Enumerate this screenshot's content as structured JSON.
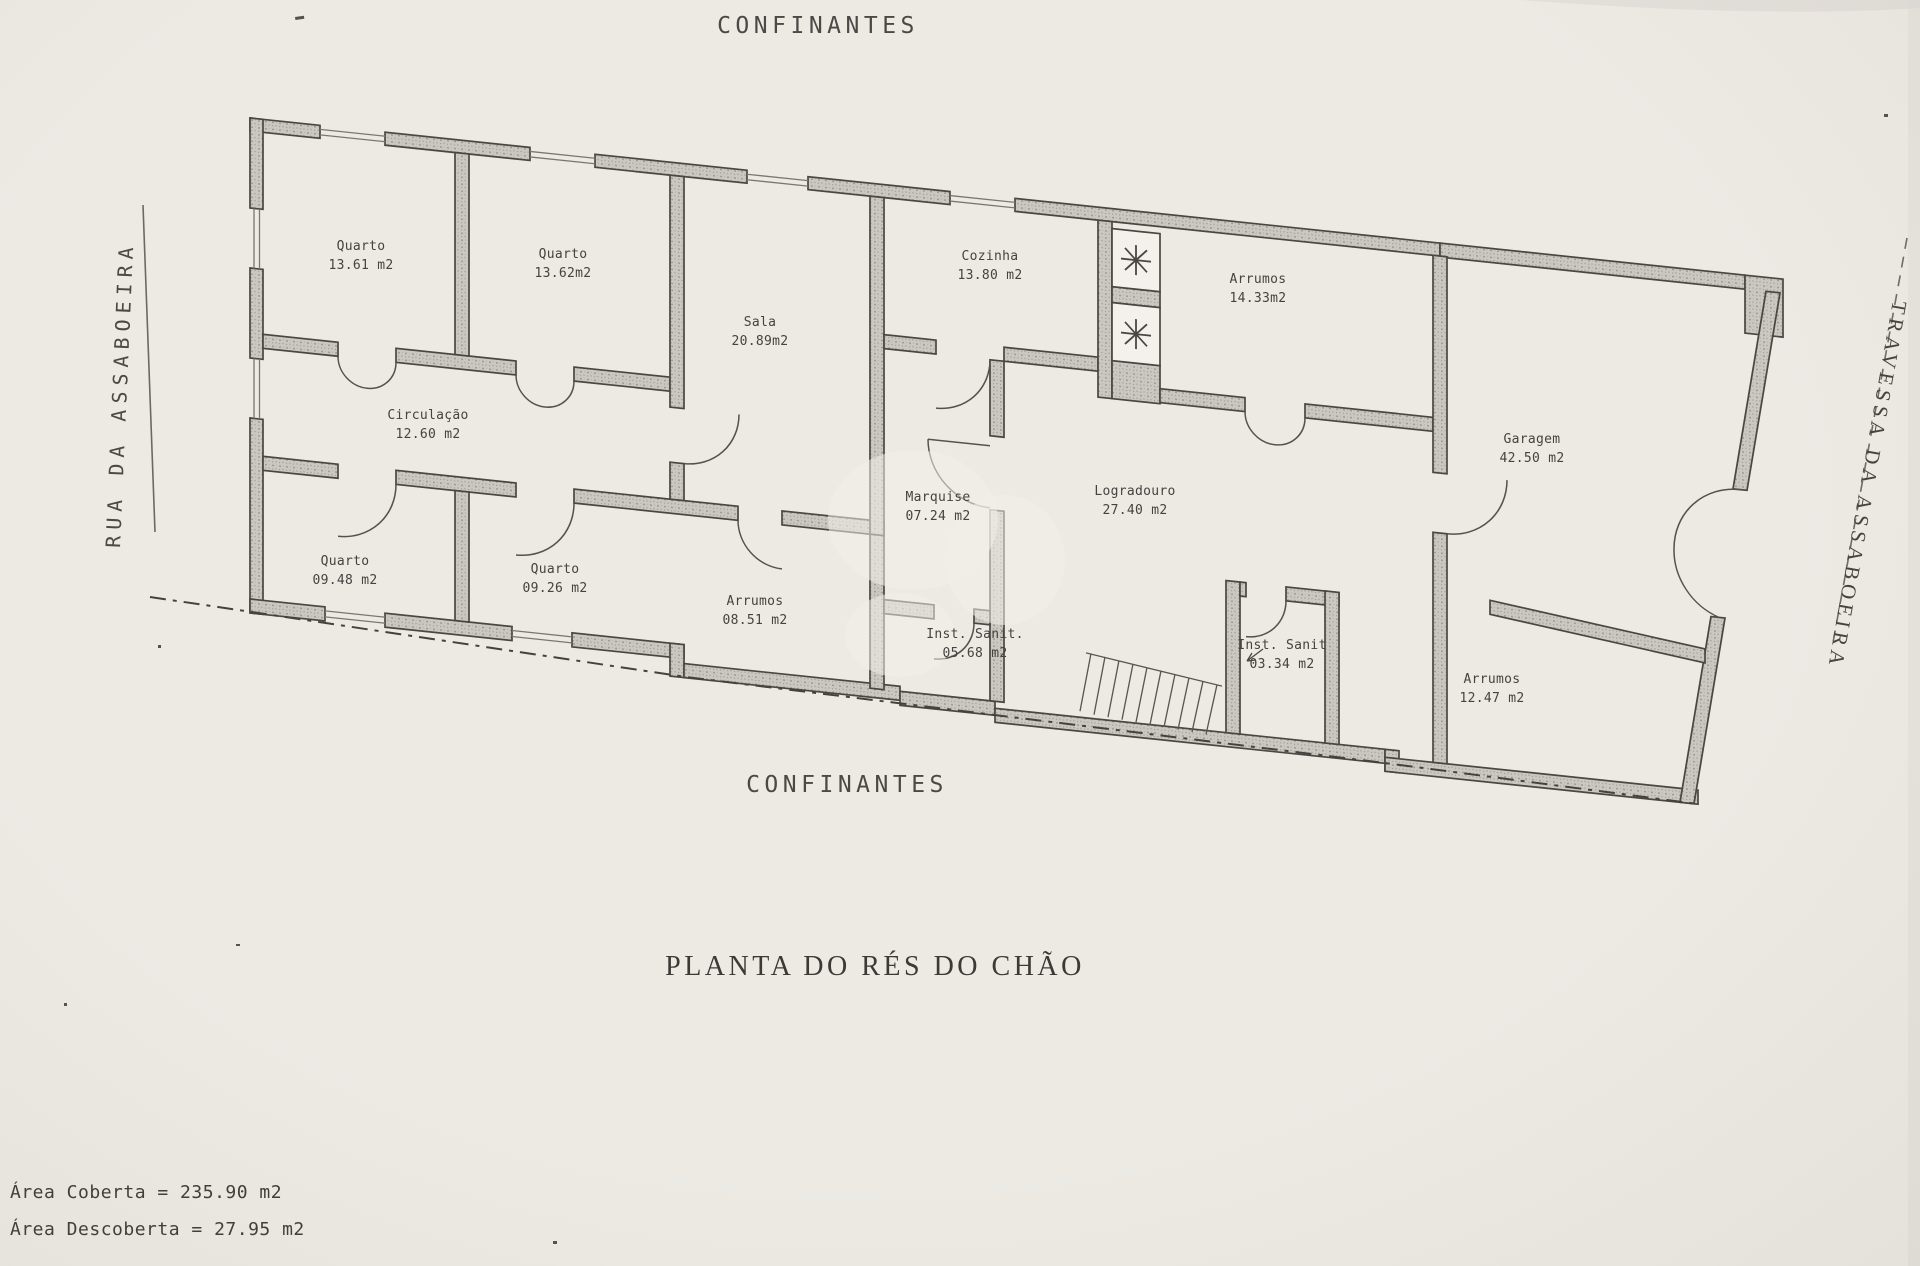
{
  "document": {
    "plan_title": "PLANTA DO RÉS DO CHÃO",
    "area_covered": "Área Coberta = 235.90 m2",
    "area_uncovered": "Área Descoberta = 27.95 m2"
  },
  "boundaries": {
    "top_label": "CONFINANTES",
    "bottom_label": "CONFINANTES",
    "left_street": "RUA DA ASSABOEIRA",
    "right_street": "TRAVESSA DA ASSABOEIRA"
  },
  "rooms": [
    {
      "name": "Quarto",
      "area": "13.61 m2"
    },
    {
      "name": "Quarto",
      "area": "13.62m2"
    },
    {
      "name": "Sala",
      "area": "20.89m2"
    },
    {
      "name": "Cozinha",
      "area": "13.80 m2"
    },
    {
      "name": "Arrumos",
      "area": "14.33m2"
    },
    {
      "name": "Circulação",
      "area": "12.60 m2"
    },
    {
      "name": "Quarto",
      "area": "09.48 m2"
    },
    {
      "name": "Quarto",
      "area": "09.26 m2"
    },
    {
      "name": "Arrumos",
      "area": "08.51 m2"
    },
    {
      "name": "Marquise",
      "area": "07.24 m2"
    },
    {
      "name": "Logradouro",
      "area": "27.40 m2"
    },
    {
      "name": "Inst. Sanit.",
      "area": "05.68 m2"
    },
    {
      "name": "Inst. Sanit",
      "area": "03.34 m2"
    },
    {
      "name": "Garagem",
      "area": "42.50 m2"
    },
    {
      "name": "Arrumos",
      "area": "12.47 m2"
    }
  ],
  "colors": {
    "paper": "#edeae4",
    "ink": "#45433f",
    "wall_fill": "#cbc8c2"
  }
}
